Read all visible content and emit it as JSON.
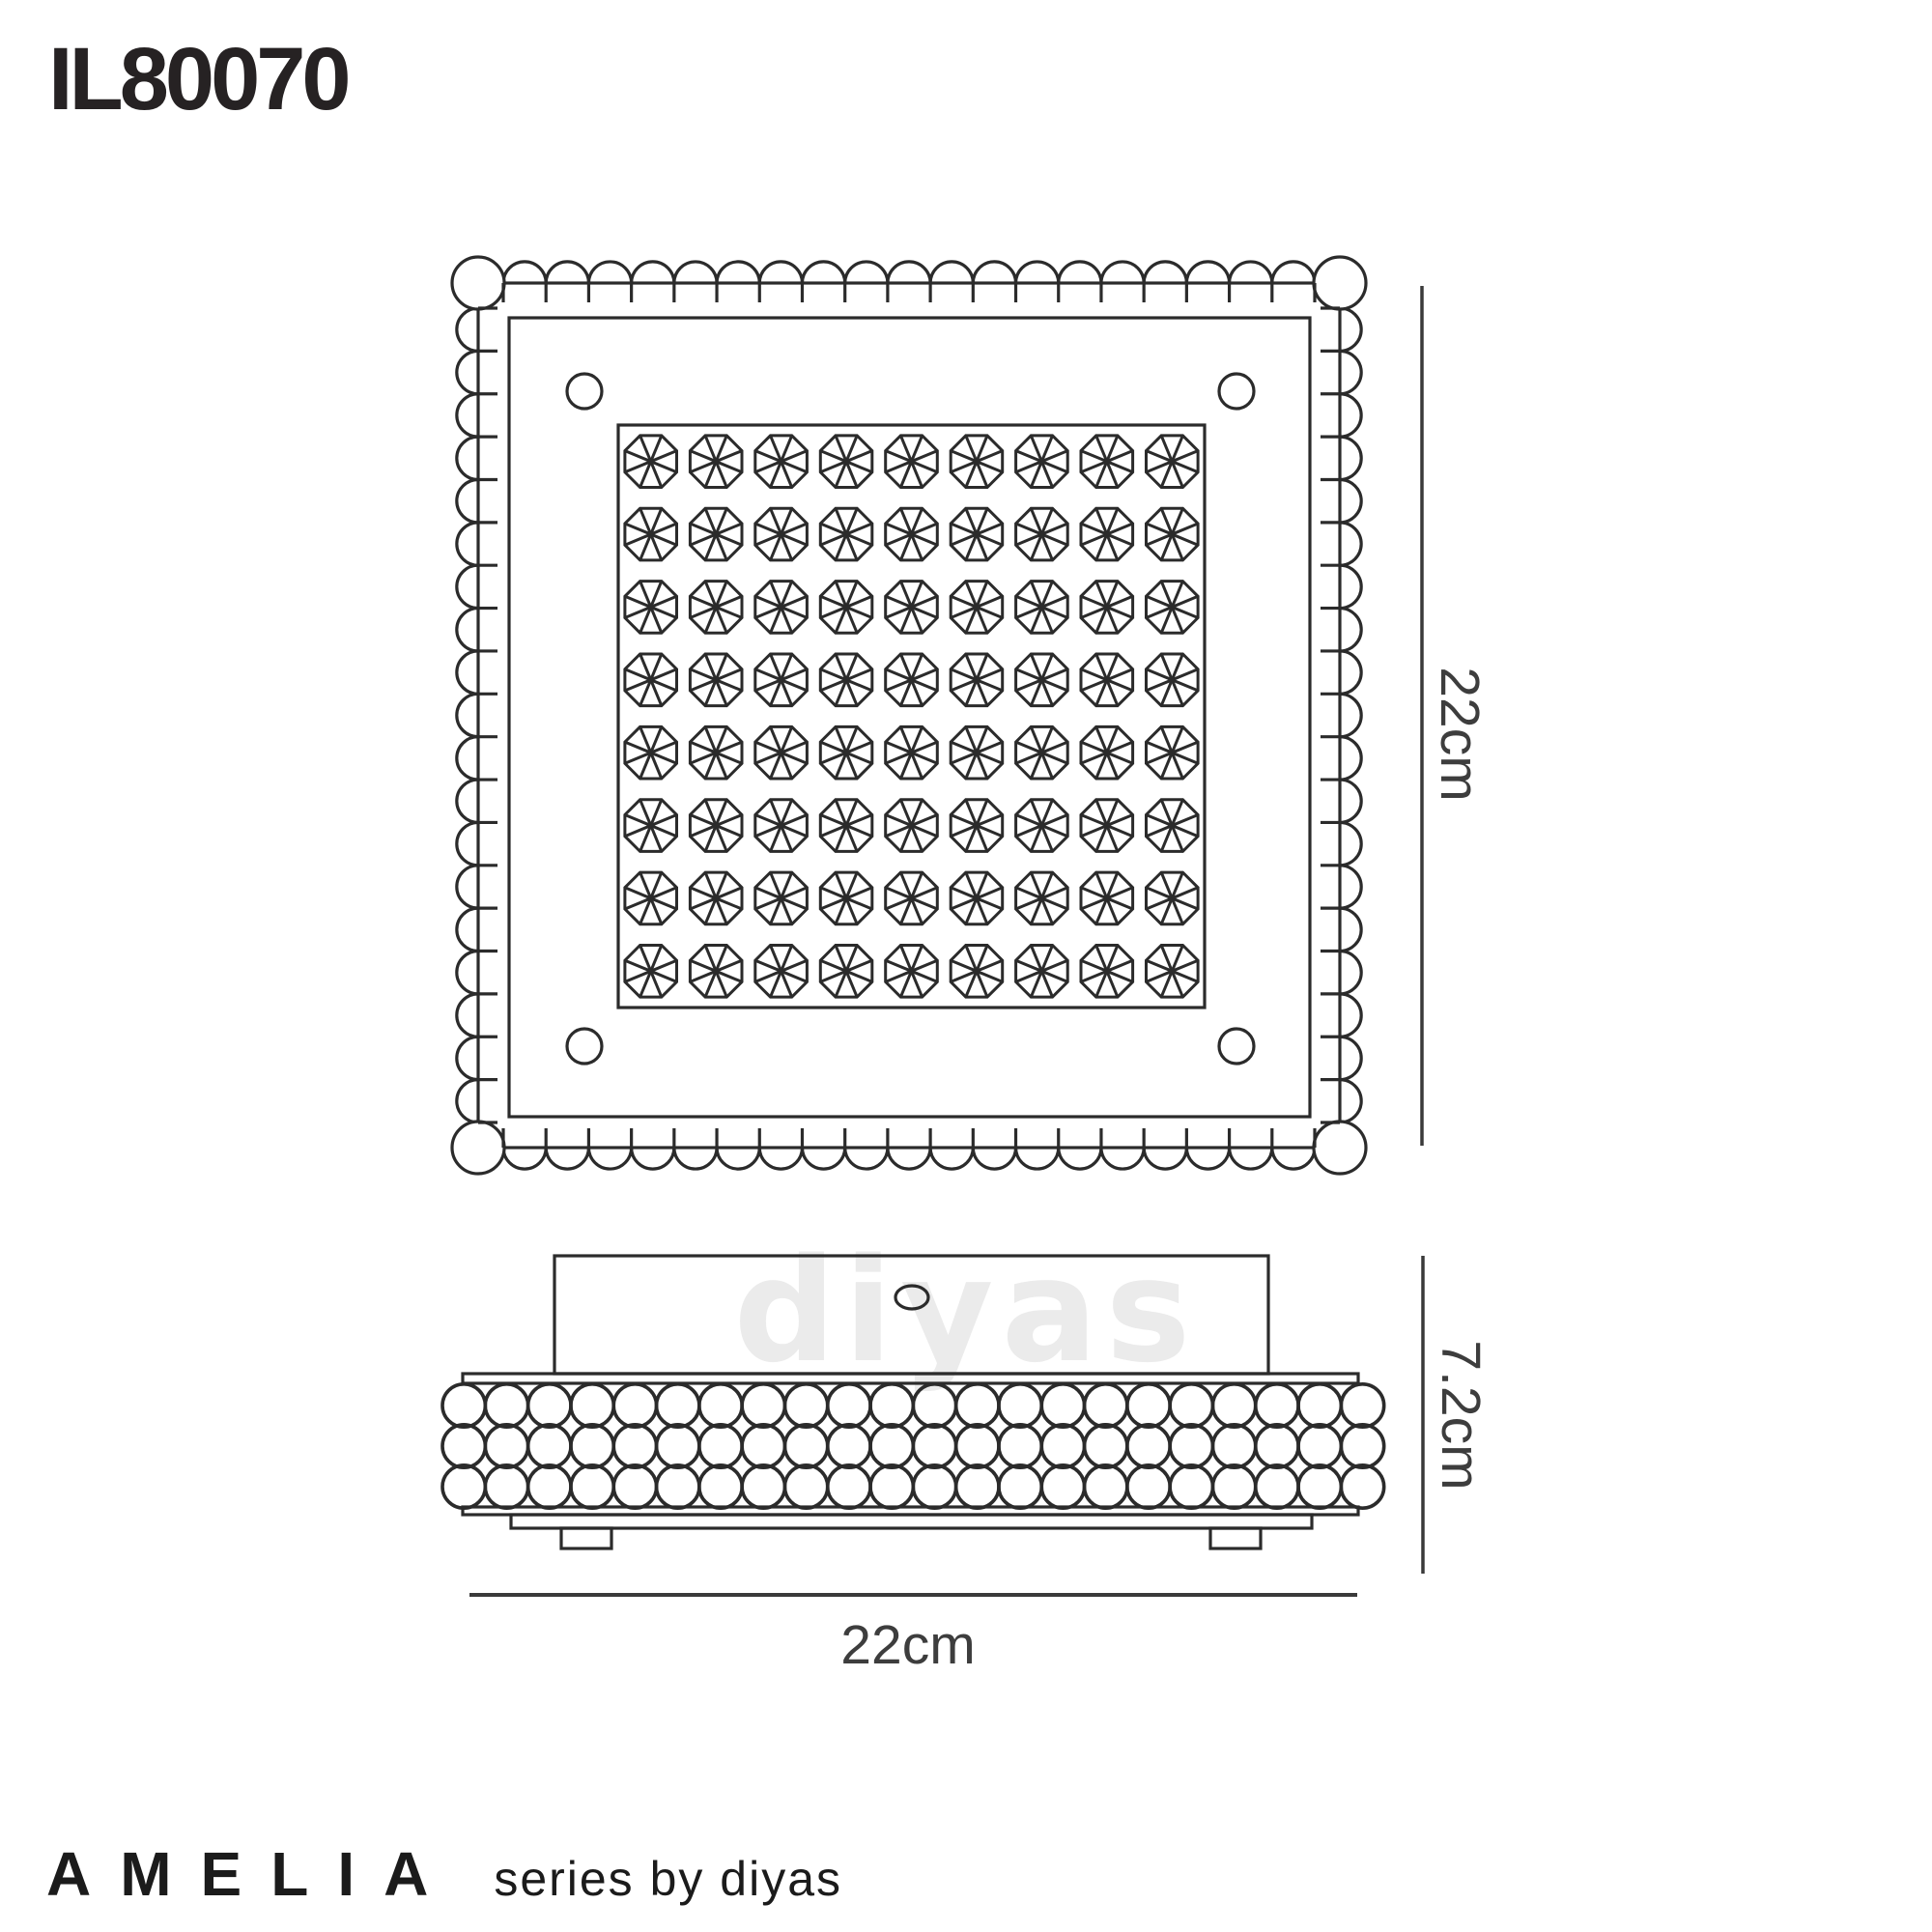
{
  "product_code": "IL80070",
  "watermark_text": "diyas",
  "dimensions": {
    "top_view_size": "22cm",
    "side_width": "22cm",
    "side_height": "7.2cm"
  },
  "footer": {
    "series_name": "AMELIA",
    "series_tagline": "series by diyas"
  },
  "top_view": {
    "grid_columns": 9,
    "grid_rows": 8,
    "crystal_count": 72,
    "scallops_per_side": 19,
    "screw_holes": 4
  },
  "side_view": {
    "bead_rows": 3,
    "beads_per_row": 22,
    "feet_count": 2
  },
  "colors": {
    "background": "#ffffff",
    "line": "#2b2b2b",
    "dim_line": "#3a3a3a",
    "dim_text": "#3d3d3d",
    "heading_text": "#262223",
    "watermark": "#ebebeb"
  }
}
